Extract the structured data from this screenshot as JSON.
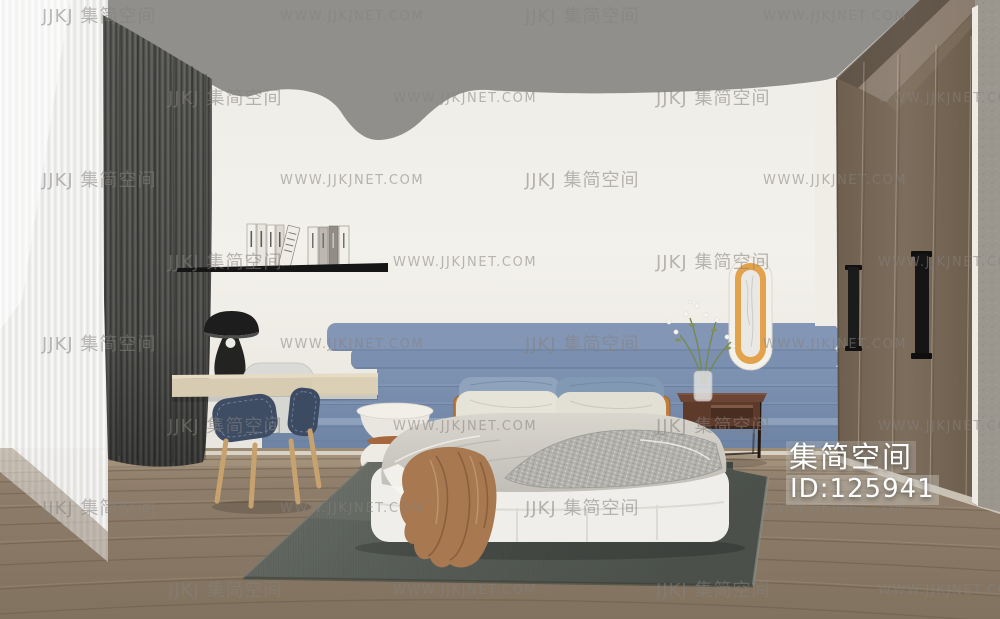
{
  "image": {
    "kind": "3d-interior-render",
    "room": "bedroom"
  },
  "watermark": {
    "logo_text": "JJKJ 集简空间",
    "url_text": "WWW.JJKJNET.COM",
    "color": "rgba(133,130,126,0.55)",
    "rows": [
      {
        "y": 7,
        "items": [
          {
            "x": 42,
            "kind": "logo"
          },
          {
            "x": 280,
            "kind": "url"
          },
          {
            "x": 525,
            "kind": "logo"
          },
          {
            "x": 763,
            "kind": "url"
          }
        ]
      },
      {
        "y": 89,
        "items": [
          {
            "x": 168,
            "kind": "logo"
          },
          {
            "x": 393,
            "kind": "url"
          },
          {
            "x": 656,
            "kind": "logo"
          },
          {
            "x": 878,
            "kind": "url"
          }
        ]
      },
      {
        "y": 171,
        "items": [
          {
            "x": 42,
            "kind": "logo"
          },
          {
            "x": 280,
            "kind": "url"
          },
          {
            "x": 525,
            "kind": "logo"
          },
          {
            "x": 763,
            "kind": "url"
          }
        ]
      },
      {
        "y": 253,
        "items": [
          {
            "x": 168,
            "kind": "logo"
          },
          {
            "x": 393,
            "kind": "url"
          },
          {
            "x": 656,
            "kind": "logo"
          },
          {
            "x": 878,
            "kind": "url"
          }
        ]
      },
      {
        "y": 335,
        "items": [
          {
            "x": 42,
            "kind": "logo"
          },
          {
            "x": 280,
            "kind": "url"
          },
          {
            "x": 525,
            "kind": "logo"
          },
          {
            "x": 763,
            "kind": "url"
          }
        ]
      },
      {
        "y": 417,
        "items": [
          {
            "x": 168,
            "kind": "logo"
          },
          {
            "x": 393,
            "kind": "url"
          },
          {
            "x": 656,
            "kind": "logo"
          },
          {
            "x": 878,
            "kind": "url"
          }
        ]
      },
      {
        "y": 499,
        "items": [
          {
            "x": 42,
            "kind": "logo"
          },
          {
            "x": 280,
            "kind": "url"
          },
          {
            "x": 525,
            "kind": "logo"
          },
          {
            "x": 763,
            "kind": "url"
          }
        ]
      },
      {
        "y": 581,
        "items": [
          {
            "x": 168,
            "kind": "logo"
          },
          {
            "x": 393,
            "kind": "url"
          },
          {
            "x": 656,
            "kind": "logo"
          },
          {
            "x": 878,
            "kind": "url"
          }
        ]
      }
    ]
  },
  "brand": {
    "name": "集简空间",
    "id_label": "ID:125941",
    "color": "#ffffff"
  },
  "palette": {
    "ceiling": "#908f8c",
    "wall": "#f2f0ea",
    "accent_wall_blue": "#7589ab",
    "sheer_curtain": "#f4f4f3",
    "blackout_curtain": "#4d4d4b",
    "floor_wood": "#8d7c69",
    "rug": "#575c56",
    "bed_base": "#efeeeb",
    "duvet": "#ccc9c1",
    "pillow_blue": "#8299b4",
    "pillow_white": "#e4e1d7",
    "throw_blanket": "#a87950",
    "nightstand": "#5e3a2b",
    "mirror_frame": "#e3a24c",
    "wardrobe_wood": "#7b6b5a",
    "desk_wood": "#d7cbb2",
    "chair_cushion": "#3e4d64",
    "lamp": "#1d1d1d"
  },
  "scene": {
    "objects": [
      "ceiling-canopy",
      "back-wall",
      "accent-wall-panels",
      "wall-mirror",
      "wardrobe",
      "wardrobe-handles",
      "concrete-pillar",
      "sheer-curtain",
      "blackout-curtain",
      "wall-shelf",
      "books",
      "table-lamp",
      "desk",
      "desk-chair",
      "side-table",
      "bed",
      "pillows",
      "duvet",
      "knit-throw",
      "brown-throw-blanket",
      "nightstand",
      "vase-with-flowers",
      "wood-floor",
      "area-rug"
    ]
  }
}
